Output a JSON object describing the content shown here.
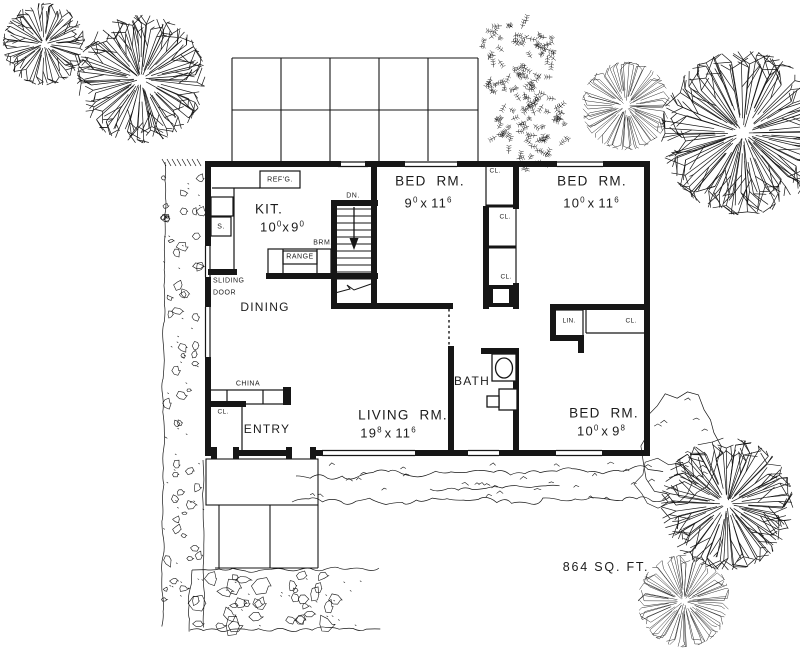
{
  "plan": {
    "area_label": "864 SQ. FT.",
    "rooms": {
      "kitchen": {
        "name": "KIT.",
        "dim": {
          "w": "10",
          "ws": "0",
          "sep": "x",
          "h": "9",
          "hs": "0"
        }
      },
      "dining": {
        "name": "DINING"
      },
      "entry": {
        "name": "ENTRY"
      },
      "living": {
        "name": "LIVING RM.",
        "dim": {
          "w": "19",
          "ws": "8",
          "sep": "x",
          "h": "11",
          "hs": "6"
        }
      },
      "bath": {
        "name": "BATH"
      },
      "bed1": {
        "name": "BED RM.",
        "dim": {
          "w": "9",
          "ws": "0",
          "sep": "x",
          "h": "11",
          "hs": "6"
        }
      },
      "bed2": {
        "name": "BED RM.",
        "dim": {
          "w": "10",
          "ws": "0",
          "sep": "x",
          "h": "11",
          "hs": "6"
        }
      },
      "bed3": {
        "name": "BED RM.",
        "dim": {
          "w": "10",
          "ws": "0",
          "sep": "x",
          "h": "9",
          "hs": "8"
        }
      }
    },
    "labels": {
      "refrigerator": "REF'G.",
      "sink": "S.",
      "range": "RANGE",
      "broom": "BRM.",
      "down": "DN.",
      "sliding_line1": "SLIDING",
      "sliding_line2": "DOOR",
      "china": "CHINA",
      "linen": "LIN.",
      "closet": "CL."
    }
  }
}
